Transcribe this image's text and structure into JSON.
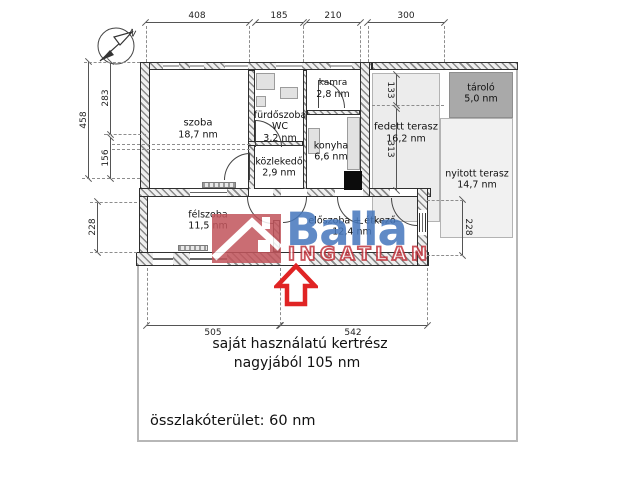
{
  "compass": {
    "label": "N"
  },
  "rooms": {
    "szoba": {
      "name": "szoba",
      "area": "18,7 nm"
    },
    "furdoszoba": {
      "name": "fürdőszoba",
      "line2": "WC",
      "area": "3,2 nm"
    },
    "kamra": {
      "name": "kamra",
      "area": "2,8 nm"
    },
    "konyha": {
      "name": "konyha",
      "area": "6,6 nm"
    },
    "kozlekedo": {
      "name": "közlekedő",
      "area": "2,9 nm"
    },
    "fedett_terasz": {
      "name": "fedett terasz",
      "area": "16,2 nm"
    },
    "tarolo": {
      "name": "tároló",
      "area": "5,0 nm"
    },
    "nyitott_terasz": {
      "name": "nyitott terasz",
      "area": "14,7 nm"
    },
    "felszoba": {
      "name": "félszoba",
      "area": "11,5 nm"
    },
    "eloszoba": {
      "name": "előszoba + étkező",
      "area": "12,4 nm"
    }
  },
  "dims": {
    "top": [
      "408",
      "185",
      "210",
      "300"
    ],
    "left": [
      "458",
      "283",
      "156",
      "228"
    ],
    "inner": [
      "133",
      "313",
      "228"
    ],
    "bottom": [
      "505",
      "542"
    ]
  },
  "notes": {
    "garden_line1": "saját használatú kertrész",
    "garden_line2": "nagyjából 105 nm",
    "total_area": "összlakóterület: 60 nm"
  },
  "watermark": {
    "brand": "Balla",
    "subtitle": "INGATLAN"
  },
  "colors": {
    "brand_blue": "#4678bd",
    "brand_red": "#c2444d",
    "logo_box": "#c2565d",
    "arrow_red": "#e02424",
    "terrace_fill": "#ececec",
    "open_terrace_fill": "#f1f1f1",
    "storage_fill": "#a9a9a9"
  }
}
